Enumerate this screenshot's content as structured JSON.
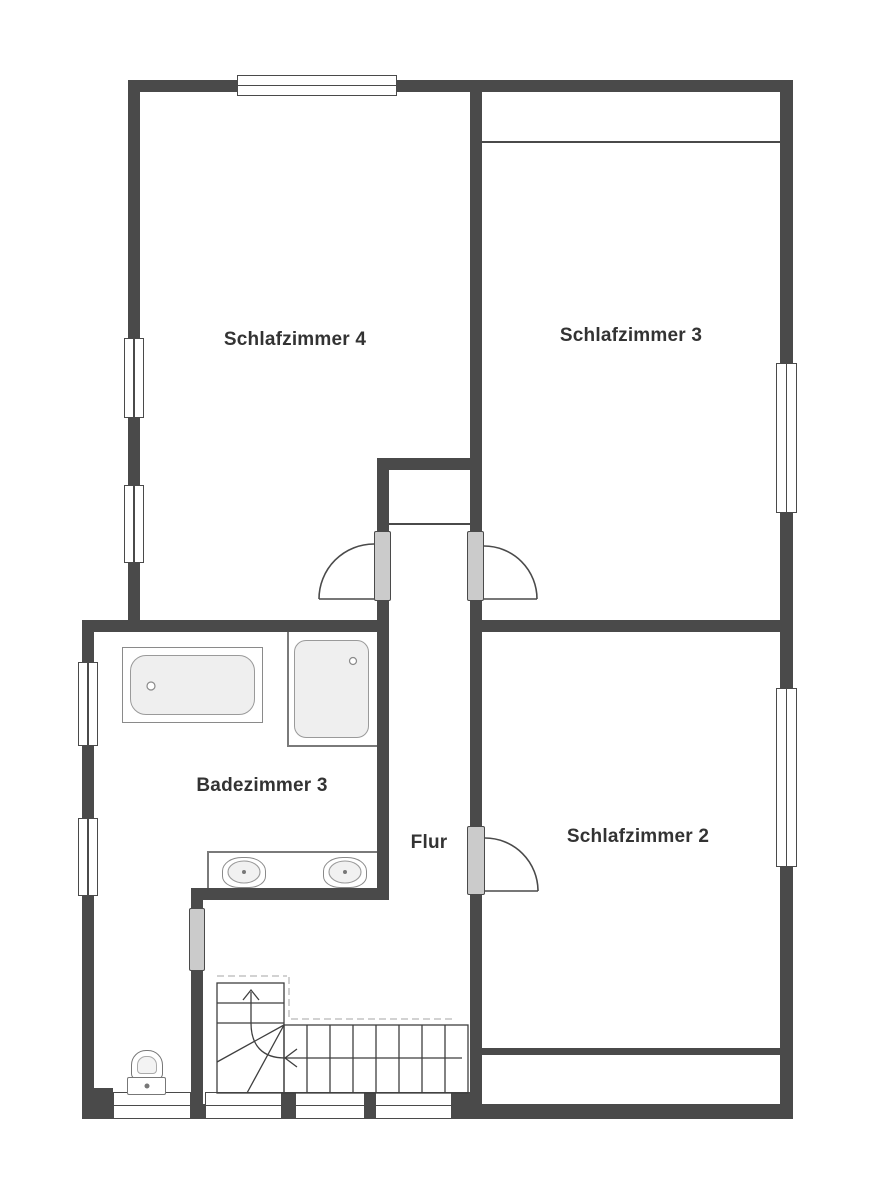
{
  "rooms": [
    {
      "id": "schlafzimmer-4",
      "label": "Schlafzimmer 4"
    },
    {
      "id": "schlafzimmer-3",
      "label": "Schlafzimmer 3"
    },
    {
      "id": "badezimmer-3",
      "label": "Badezimmer 3"
    },
    {
      "id": "flur",
      "label": "Flur"
    },
    {
      "id": "schlafzimmer-2",
      "label": "Schlafzimmer 2"
    }
  ],
  "fixtures": [
    {
      "name": "bathtub"
    },
    {
      "name": "shower"
    },
    {
      "name": "washbasin-left"
    },
    {
      "name": "washbasin-right"
    },
    {
      "name": "toilet"
    },
    {
      "name": "staircase"
    }
  ],
  "colors": {
    "wall": "#4a4a4a",
    "door_jamb": "#cbcbcb",
    "fixture_fill": "#efefef",
    "linework": "#3f3f3f",
    "dashed_line": "#b8b8b8",
    "background": "#ffffff",
    "text": "#333333"
  }
}
